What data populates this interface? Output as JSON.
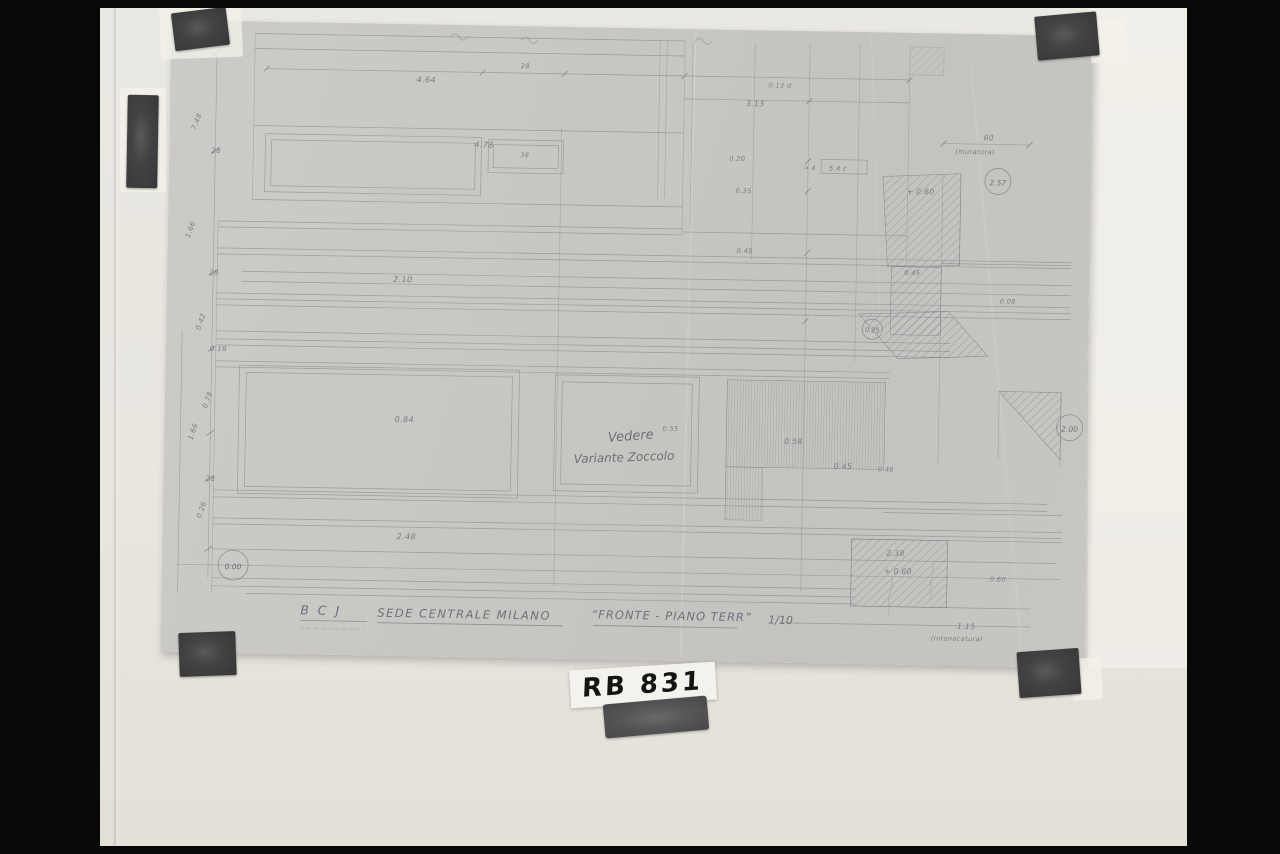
{
  "photo": {
    "label": {
      "text": "RB 831"
    },
    "sheet": {
      "title": {
        "part1": "B C J",
        "part2": "SEDE CENTRALE MILANO",
        "part3": "“FRONTE - PIANO TERR”",
        "scale": "1/10"
      },
      "handwritten_note": {
        "line1": "Vedere",
        "line2": "Variante Zoccolo"
      },
      "datums": {
        "baseline": "0.00",
        "upper_right": "2.57",
        "mid_right": "0.25",
        "edge_right": "2.00"
      },
      "annotations": [
        {
          "text": "7.48",
          "x": 26,
          "y": 110,
          "s": 7,
          "rot": -70
        },
        {
          "text": "28",
          "x": 42,
          "y": 132,
          "s": 7
        },
        {
          "text": "1.66",
          "x": 22,
          "y": 218,
          "s": 7,
          "rot": -72
        },
        {
          "text": "28",
          "x": 42,
          "y": 254,
          "s": 7
        },
        {
          "text": "0.42",
          "x": 34,
          "y": 310,
          "s": 7,
          "rot": -72
        },
        {
          "text": "0.18",
          "x": 44,
          "y": 330,
          "s": 7
        },
        {
          "text": "0.78",
          "x": 42,
          "y": 388,
          "s": 7,
          "rot": -72
        },
        {
          "text": "1.66",
          "x": 28,
          "y": 420,
          "s": 7,
          "rot": -72
        },
        {
          "text": "28",
          "x": 42,
          "y": 460,
          "s": 7
        },
        {
          "text": "0.26",
          "x": 38,
          "y": 498,
          "s": 7,
          "rot": -72
        },
        {
          "text": "4.64",
          "x": 246,
          "y": 58,
          "s": 8
        },
        {
          "text": "28",
          "x": 350,
          "y": 42,
          "s": 6.5
        },
        {
          "text": "4.78",
          "x": 305,
          "y": 122,
          "s": 8
        },
        {
          "text": "38",
          "x": 351,
          "y": 131,
          "s": 6.5
        },
        {
          "text": "0.13 d",
          "x": 598,
          "y": 57,
          "s": 6.5
        },
        {
          "text": "3.13",
          "x": 576,
          "y": 76,
          "s": 7.5
        },
        {
          "text": "0.20",
          "x": 560,
          "y": 131,
          "s": 6.5
        },
        {
          "text": "0.35",
          "x": 567,
          "y": 163,
          "s": 6.5
        },
        {
          "text": "0.45",
          "x": 569,
          "y": 223,
          "s": 6.5
        },
        {
          "text": "→ 4",
          "x": 634,
          "y": 139,
          "s": 6.5
        },
        {
          "text": "5.4 c",
          "x": 660,
          "y": 139,
          "s": 6.5
        },
        {
          "text": "+ 0.60",
          "x": 738,
          "y": 161,
          "s": 7.5
        },
        {
          "text": "0.45",
          "x": 737,
          "y": 242,
          "s": 6.5
        },
        {
          "text": "0.08",
          "x": 833,
          "y": 269,
          "s": 6.5
        },
        {
          "text": "60",
          "x": 814,
          "y": 106,
          "s": 7.5
        },
        {
          "text": "(muratura)",
          "x": 786,
          "y": 120,
          "s": 6.5
        },
        {
          "text": "2.10",
          "x": 226,
          "y": 258,
          "s": 8
        },
        {
          "text": "0.84",
          "x": 230,
          "y": 398,
          "s": 8
        },
        {
          "text": "0.55",
          "x": 498,
          "y": 402,
          "s": 6.5
        },
        {
          "text": "0.58",
          "x": 620,
          "y": 413,
          "s": 7.5
        },
        {
          "text": "0.45",
          "x": 670,
          "y": 437,
          "s": 7.5
        },
        {
          "text": "0.46",
          "x": 714,
          "y": 439,
          "s": 6.5
        },
        {
          "text": "2.48",
          "x": 234,
          "y": 515,
          "s": 8
        },
        {
          "text": "2.38",
          "x": 724,
          "y": 523,
          "s": 7.5
        },
        {
          "text": "+ 0.60",
          "x": 722,
          "y": 541,
          "s": 7.5
        },
        {
          "text": "0.60",
          "x": 828,
          "y": 547,
          "s": 6.5
        },
        {
          "text": "1.15",
          "x": 796,
          "y": 595,
          "s": 7.5
        },
        {
          "text": "(intonacatura)",
          "x": 770,
          "y": 607,
          "s": 6.5
        }
      ]
    }
  },
  "colors": {
    "background": "#070707",
    "photo_paper": "#e8e6df",
    "tracing_sheet": "#c7c6c2",
    "pencil": "#6f727c",
    "tape_dark": "#434343",
    "label_white": "#f4f2ec",
    "marker_ink": "#141414"
  }
}
